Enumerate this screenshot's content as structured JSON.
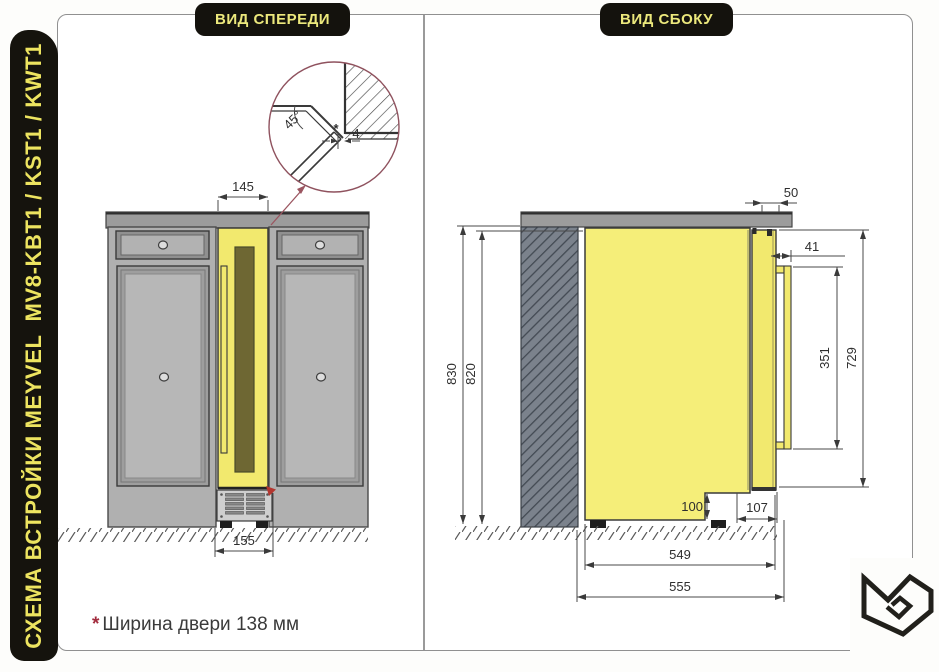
{
  "sidebar": {
    "title": "СХЕМА ВСТРОЙКИ MEYVEL  MV8-KBT1 / KST1 / KWT1"
  },
  "views": {
    "front": {
      "label": "ВИД СПЕРЕДИ",
      "dims": {
        "niche_width": "145",
        "base_width": "155"
      },
      "detail": {
        "angle": "45°",
        "gap": "4",
        "marker": "*"
      }
    },
    "side": {
      "label": "ВИД СБОКУ",
      "dims": {
        "countertop_overhang": "50",
        "handle_offset": "41",
        "handle_length": "351",
        "door_height": "729",
        "niche_height": "830",
        "unit_height": "820",
        "plinth_height": "100",
        "plinth_depth": "107",
        "body_depth": "549",
        "total_depth": "555"
      }
    }
  },
  "footnote": {
    "marker": "*",
    "text": "Ширина двери 138 мм"
  },
  "colors": {
    "accent_yellow": "#f2e96e",
    "panel_black": "#14120d",
    "marker_red": "#a43a48"
  }
}
